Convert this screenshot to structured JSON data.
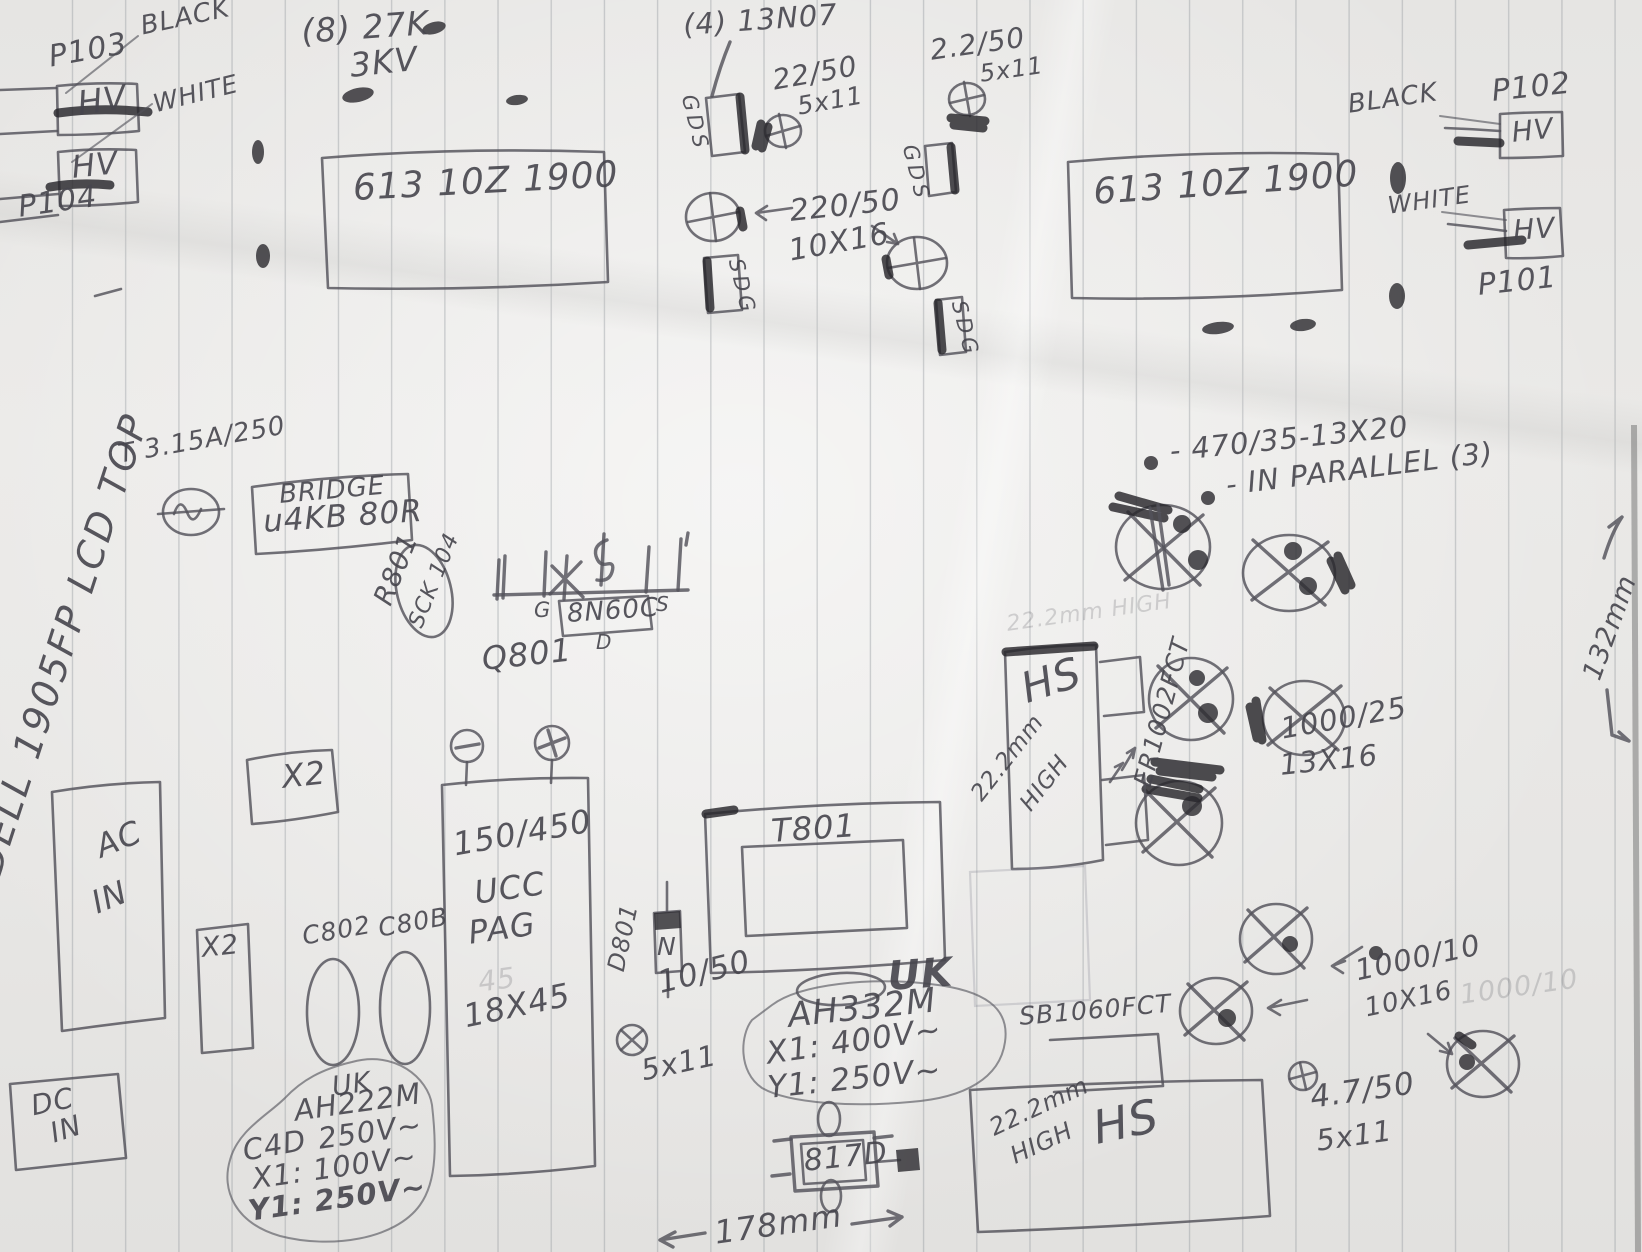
{
  "page": {
    "kind": "hand-drawn pencil sketch of the Dell 1905FP LCD power board component layout on ruled paper",
    "title_rotated": "DELL  1905FP  LCD TOP"
  },
  "top_left_connectors": {
    "p103": "P103",
    "black": "BLACK",
    "hv_top": "HV",
    "white": "WHITE",
    "hv_bottom": "HV",
    "p104": "P104"
  },
  "top_right_connectors": {
    "black": "BLACK",
    "p102": "P102",
    "hv_top": "HV",
    "white": "WHITE",
    "hv_bottom": "HV",
    "p101": "P101"
  },
  "inverter_notes": {
    "qty_27k": "(8) 27K",
    "kv_3": "3KV",
    "board1": "613 10Z 1900",
    "board2": "613 10Z 1900",
    "qty_13n07": "(4) 13N07",
    "cap_22_50": "22/50",
    "cap_22_50_size": "5x11",
    "cap_2_2_50": "2.2/50",
    "cap_2_2_50_size": "5x11",
    "gds1": "GDS",
    "gds2": "GDS",
    "sdg1": "SDG",
    "sdg2": "SDG",
    "cap_220_50": "220/50",
    "cap_220_50_size": "10X16"
  },
  "primary_side": {
    "fuse": "T 3.15A/250",
    "bridge_line1": "BRIDGE",
    "bridge_line2": "u4KB 80R",
    "r801": "R801",
    "sck104": "SCK 104",
    "pin_g": "G",
    "mosfet": "8N60C",
    "pin_s": "S",
    "pin_d": "D",
    "q801": "Q801",
    "x2_a": "X2",
    "x2_b": "X2",
    "ac_line1": "AC",
    "ac_line2": "IN",
    "dc_line1": "DC",
    "dc_line2": "IN",
    "c802": "C802",
    "c80b": "C80B",
    "bulk_cap_value": "150/450",
    "bulk_cap_brand1": "UCC",
    "bulk_cap_brand2": "PAG",
    "bulk_cap_ghost": "45",
    "bulk_cap_size": "18X45",
    "uk_brand": "UK",
    "ah222m": "AH222M",
    "c4d": "C4D",
    "v_250": "250V~",
    "x1_rating": "X1: 100V~",
    "y1_rating": "Y1: 250V~",
    "d801": "D801",
    "diode_n": "N",
    "t801": "T801",
    "cap_10_50": "10/50",
    "cap_10_50_size": "5x11",
    "uk2_brand": "UK",
    "ah332m": "AH332M",
    "x1_rating2": "X1: 400V~",
    "y1_rating2": "Y1: 250V~",
    "opto": "817D"
  },
  "secondary_side": {
    "cap_470_note": "- 470/35-13X20",
    "parallel_note": "- IN PARALLEL (3)",
    "cap_1000_25": "1000/25",
    "cap_1000_25_size": "13X16",
    "hs1": "HS",
    "hs1_height": "22.2mm",
    "hs1_high": "HIGH",
    "hs1_ghost": "22.2mm HIGH",
    "er1002fct": "ER1002FCT",
    "sb1060fct": "SB1060FCT",
    "hs2": "HS",
    "hs2_height": "22.2mm",
    "hs2_high": "HIGH",
    "cap_1000_10": "1000/10",
    "cap_1000_10_size": "10X16",
    "cap_1000_10_ghost": "1000/10",
    "cap_4_7_50": "4.7/50",
    "cap_4_7_50_size": "5x11"
  },
  "dimensions": {
    "width": "178mm",
    "height": "132mm"
  }
}
